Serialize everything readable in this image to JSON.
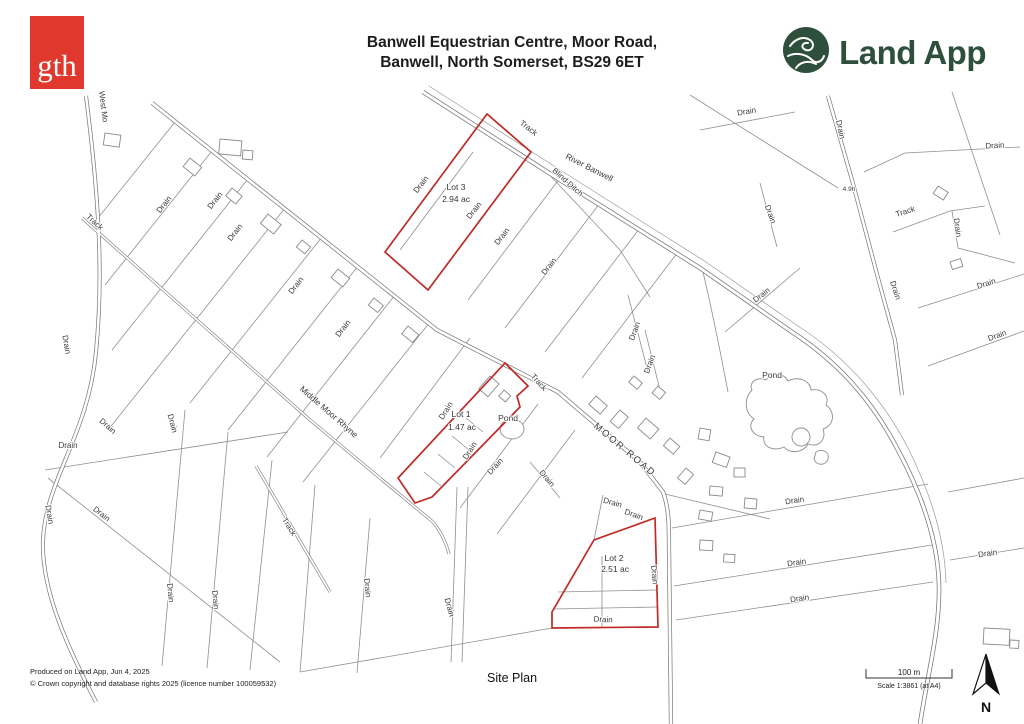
{
  "colors": {
    "gth_red": "#E0382D",
    "landapp_green": "#2D4F3C",
    "lot_outline_red": "#BF2B26",
    "map_line_gray": "#8F8F8F"
  },
  "header": {
    "gth_logo_text": "gth",
    "title_line1": "Banwell Equestrian Centre, Moor Road,",
    "title_line2": "Banwell, North Somerset, BS29 6ET",
    "landapp_name": "Land App"
  },
  "map": {
    "lots": [
      {
        "name": "Lot 3",
        "area": "2.94 ac"
      },
      {
        "name": "Lot 1",
        "area": "1.47 ac"
      },
      {
        "name": "Lot 2",
        "area": "2.51 ac"
      }
    ],
    "labels": {
      "drain": "Drain",
      "track": "Track",
      "river": "River Banwell",
      "blind_ditch": "Blind Ditch",
      "moor_road": "MOOR ROAD",
      "middle_moor_rhyne": "Middle Moor Rhyne",
      "west_moor": "West Mo",
      "pond": "Pond",
      "area_marker": "4.9h"
    }
  },
  "footer": {
    "produced": "Produced on Land App, Jun 4, 2025",
    "copyright": "© Crown copyright and database rights 2025 (licence number 100059532)",
    "plan_name": "Site Plan",
    "scale_bar_label": "100 m",
    "scale_text": "Scale 1:3861 (at A4)",
    "north_label": "N"
  }
}
